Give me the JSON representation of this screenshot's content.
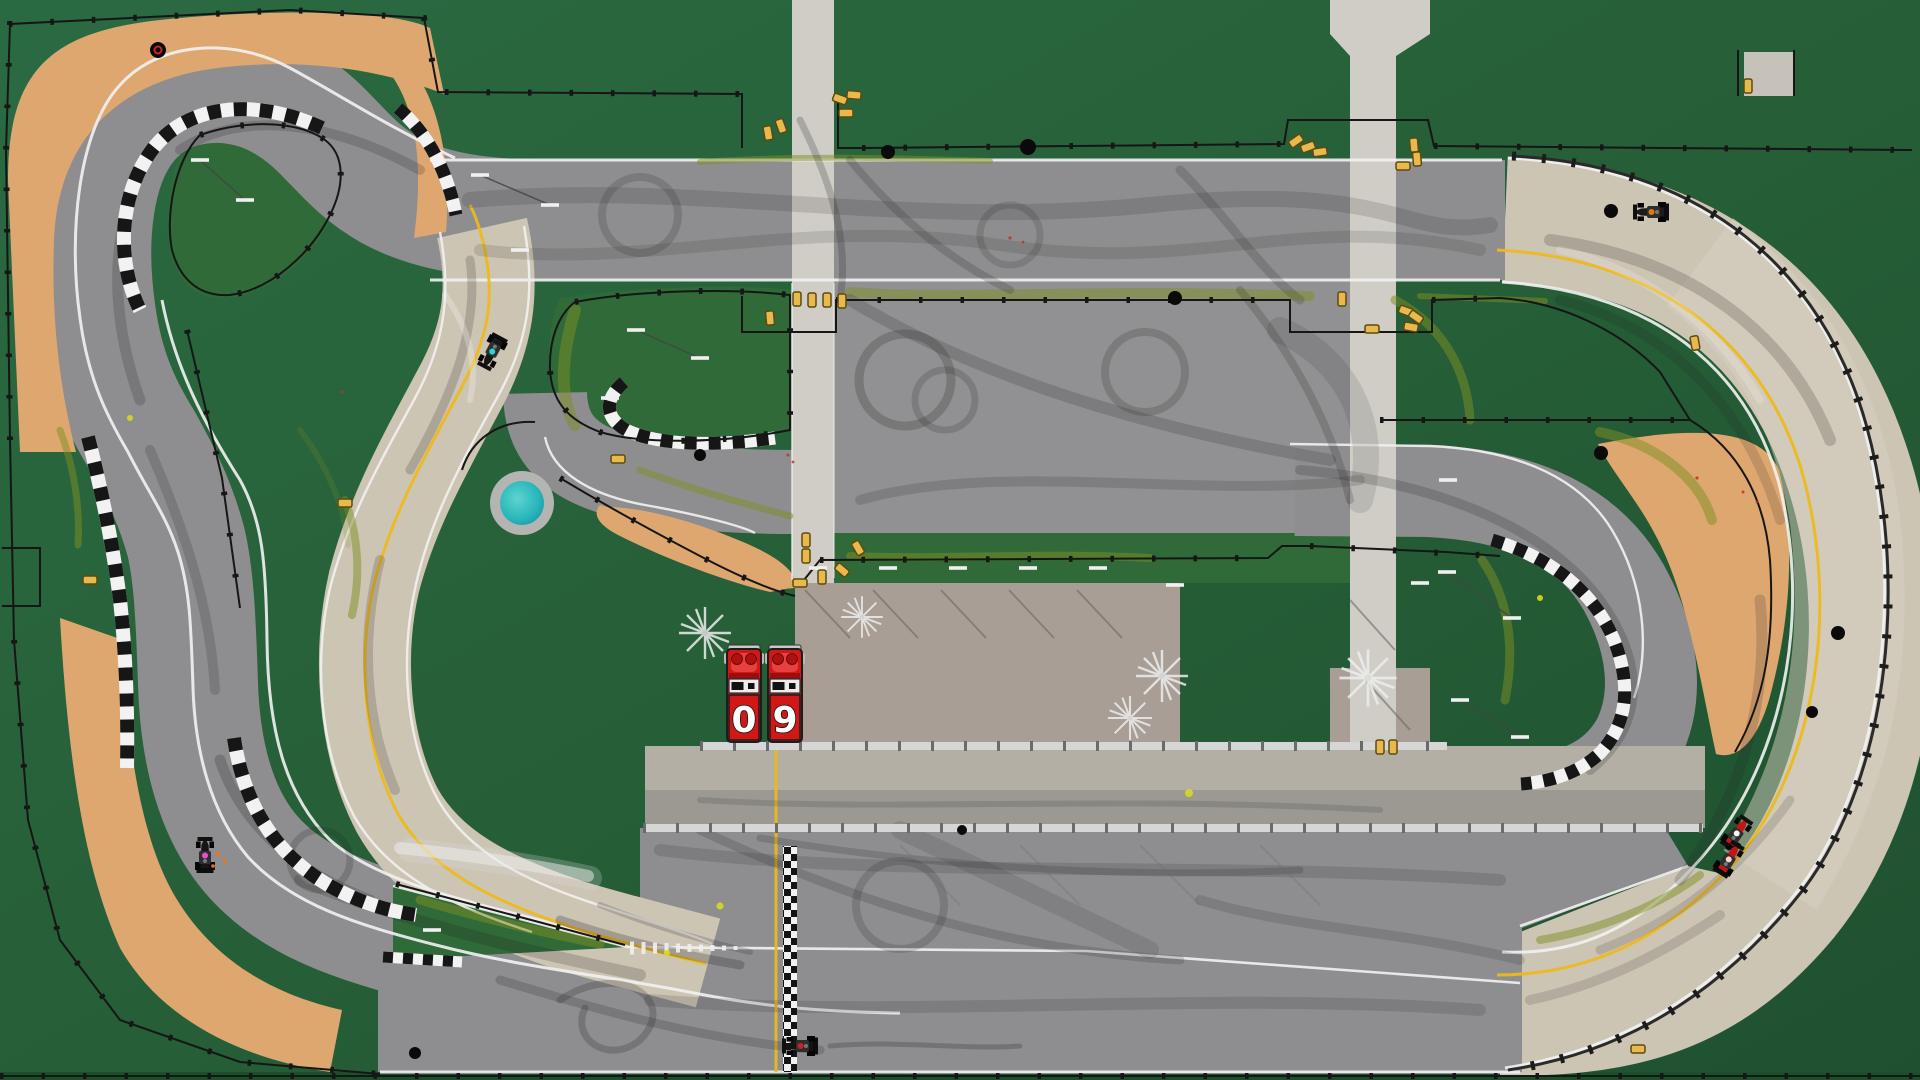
{
  "app": {
    "name": "Top-down racing game",
    "view": "track overview"
  },
  "scoreboard": {
    "value": "09",
    "digits": [
      "0",
      "9"
    ]
  },
  "colors": {
    "background_green": "#27613a",
    "background_green_dark": "#1d4f2c",
    "grass_light": "#2f6a38",
    "asphalt": "#8e8e90",
    "asphalt_band": "#919193",
    "asphalt_light": "#cdc5b4",
    "paddock": "#a89e95",
    "service_road": "#d0cdc7",
    "pit_upper": "#b4afa4",
    "pit_lower": "#9c9992",
    "sand": "#dfa770",
    "pond": "#1fb3b8",
    "pond_ring": "#b4b4b2",
    "yellow_line": "#ecb91e",
    "white_line": "#f2f2f2",
    "curb_white": "#f2f2f2",
    "curb_black": "#161616",
    "fence": "#161616",
    "guardrail": "#d6d6d6",
    "truck_red": "#d21717",
    "barrier_yellow": "#e9b94d",
    "olive_stain": "#7e8f23"
  },
  "game": {
    "trucks": [
      {
        "id": "truck-left",
        "digit": "0",
        "x": 727,
        "y": 645
      },
      {
        "id": "truck-right",
        "digit": "9",
        "x": 768,
        "y": 645
      }
    ],
    "cars": [
      {
        "id": "car-cyan",
        "x": 492,
        "y": 352,
        "rot": 118,
        "accent": "#25d6d6",
        "body": "#161616"
      },
      {
        "id": "car-magenta",
        "x": 205,
        "y": 855,
        "rot": -90,
        "accent": "#e84fd0",
        "body": "#161616"
      },
      {
        "id": "car-orange",
        "x": 1651,
        "y": 212,
        "rot": 180,
        "accent": "#e07818",
        "body": "#1c1c1c"
      },
      {
        "id": "car-red-1",
        "x": 1737,
        "y": 833,
        "rot": -55,
        "accent": "#f5f5f5",
        "body": "#c41414"
      },
      {
        "id": "car-red-2",
        "x": 1729,
        "y": 859,
        "rot": -58,
        "accent": "#ffd0d0",
        "body": "#c41414"
      },
      {
        "id": "car-black",
        "x": 800,
        "y": 1046,
        "rot": 180,
        "accent": "#cc2222",
        "body": "#141414"
      }
    ],
    "pond": {
      "x": 522,
      "y": 503,
      "radius": 22
    },
    "start_finish": {
      "x": 783,
      "y": 846,
      "height": 226
    },
    "track_features": [
      "outer-circuit",
      "infield-loops",
      "pit-lane",
      "paddock",
      "sand-traps",
      "checkered-curbs",
      "guard-rails",
      "tire-barriers"
    ]
  }
}
